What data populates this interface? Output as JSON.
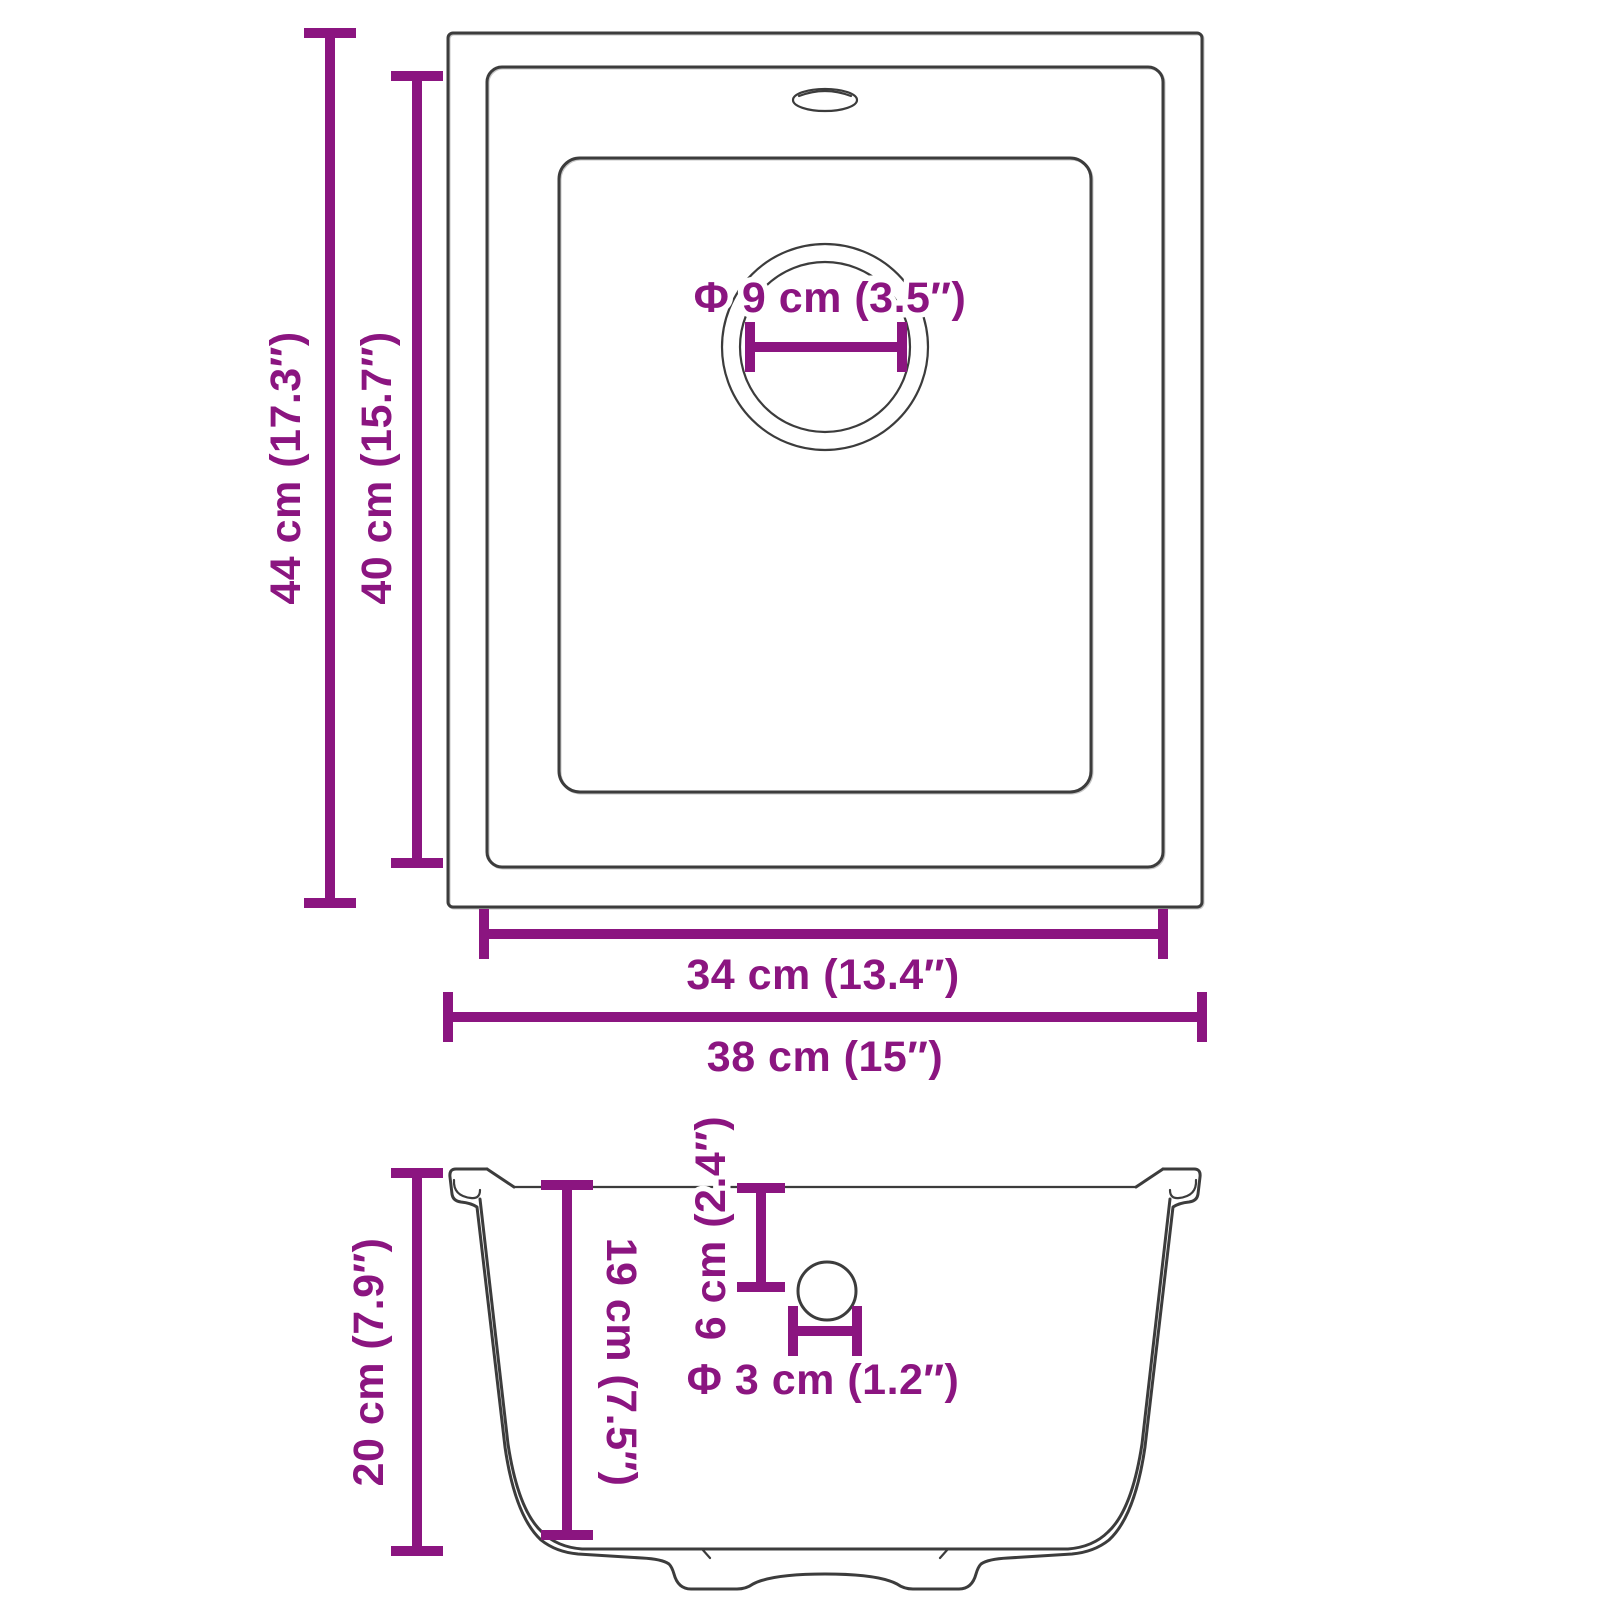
{
  "colors": {
    "dimension_accent": "#8B1580",
    "drawing_line": "#3C3C3C",
    "background": "#FFFFFF"
  },
  "top_view": {
    "outer_depth_label": "44 cm (17.3″)",
    "inner_depth_label": "40 cm (15.7″)",
    "inner_width_label": "34 cm (13.4″)",
    "outer_width_label": "38 cm (15″)",
    "drain_diameter_label": "Φ 9 cm (3.5″)"
  },
  "section_view": {
    "total_height_label": "20 cm (7.9″)",
    "bowl_depth_label": "19 cm (7.5″)",
    "overflow_offset_label": "6 cm (2.4″)",
    "overflow_diameter_label": "Φ 3 cm (1.2″)"
  }
}
